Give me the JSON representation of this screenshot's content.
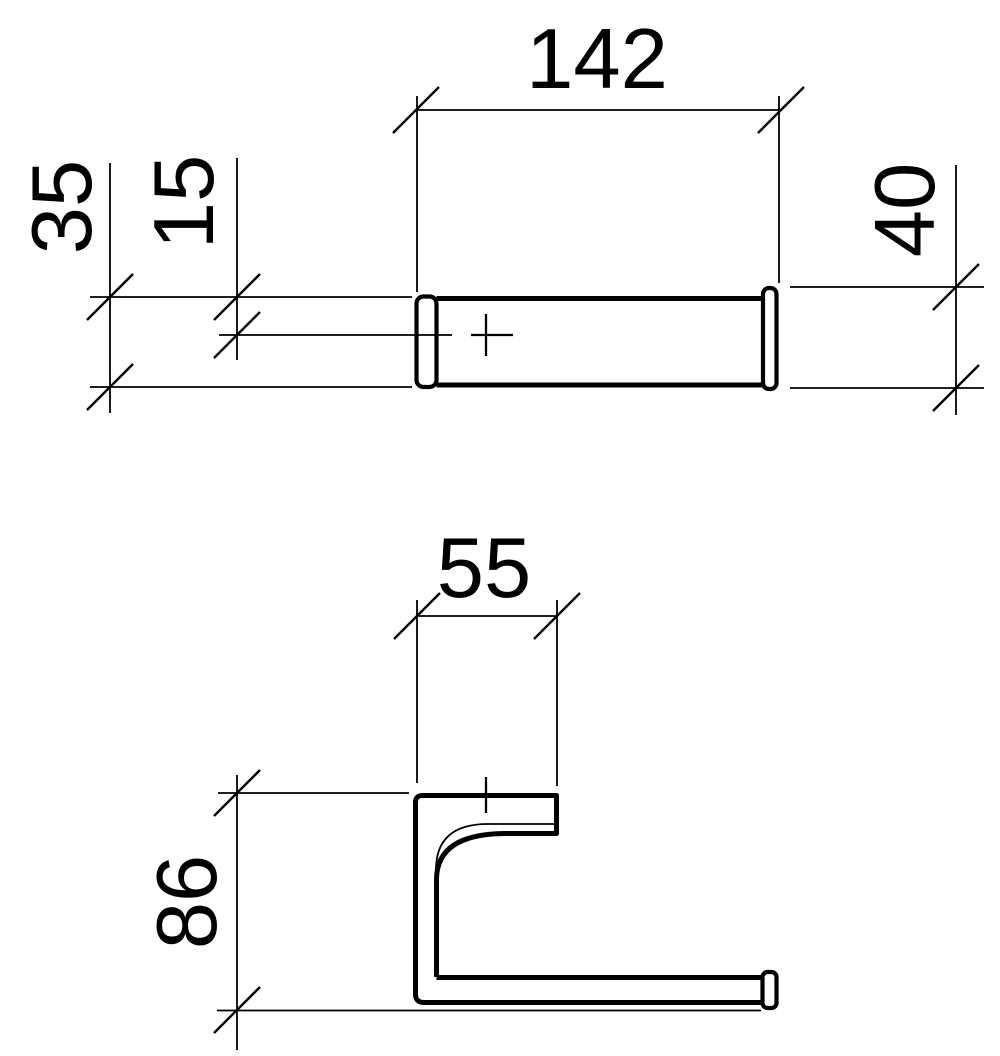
{
  "drawing": {
    "kind": "technical-dimension-drawing",
    "background": "#ffffff",
    "stroke_color": "#000000",
    "views": {
      "plan_view": {
        "name": "plan view (bar from above)",
        "dims": {
          "overall_width": "142",
          "depth": "35",
          "center_offset": "15",
          "end_cap_depth": "40"
        }
      },
      "side_view": {
        "name": "side profile view",
        "dims": {
          "bracket_top_width": "55",
          "overall_height": "86"
        }
      }
    }
  }
}
